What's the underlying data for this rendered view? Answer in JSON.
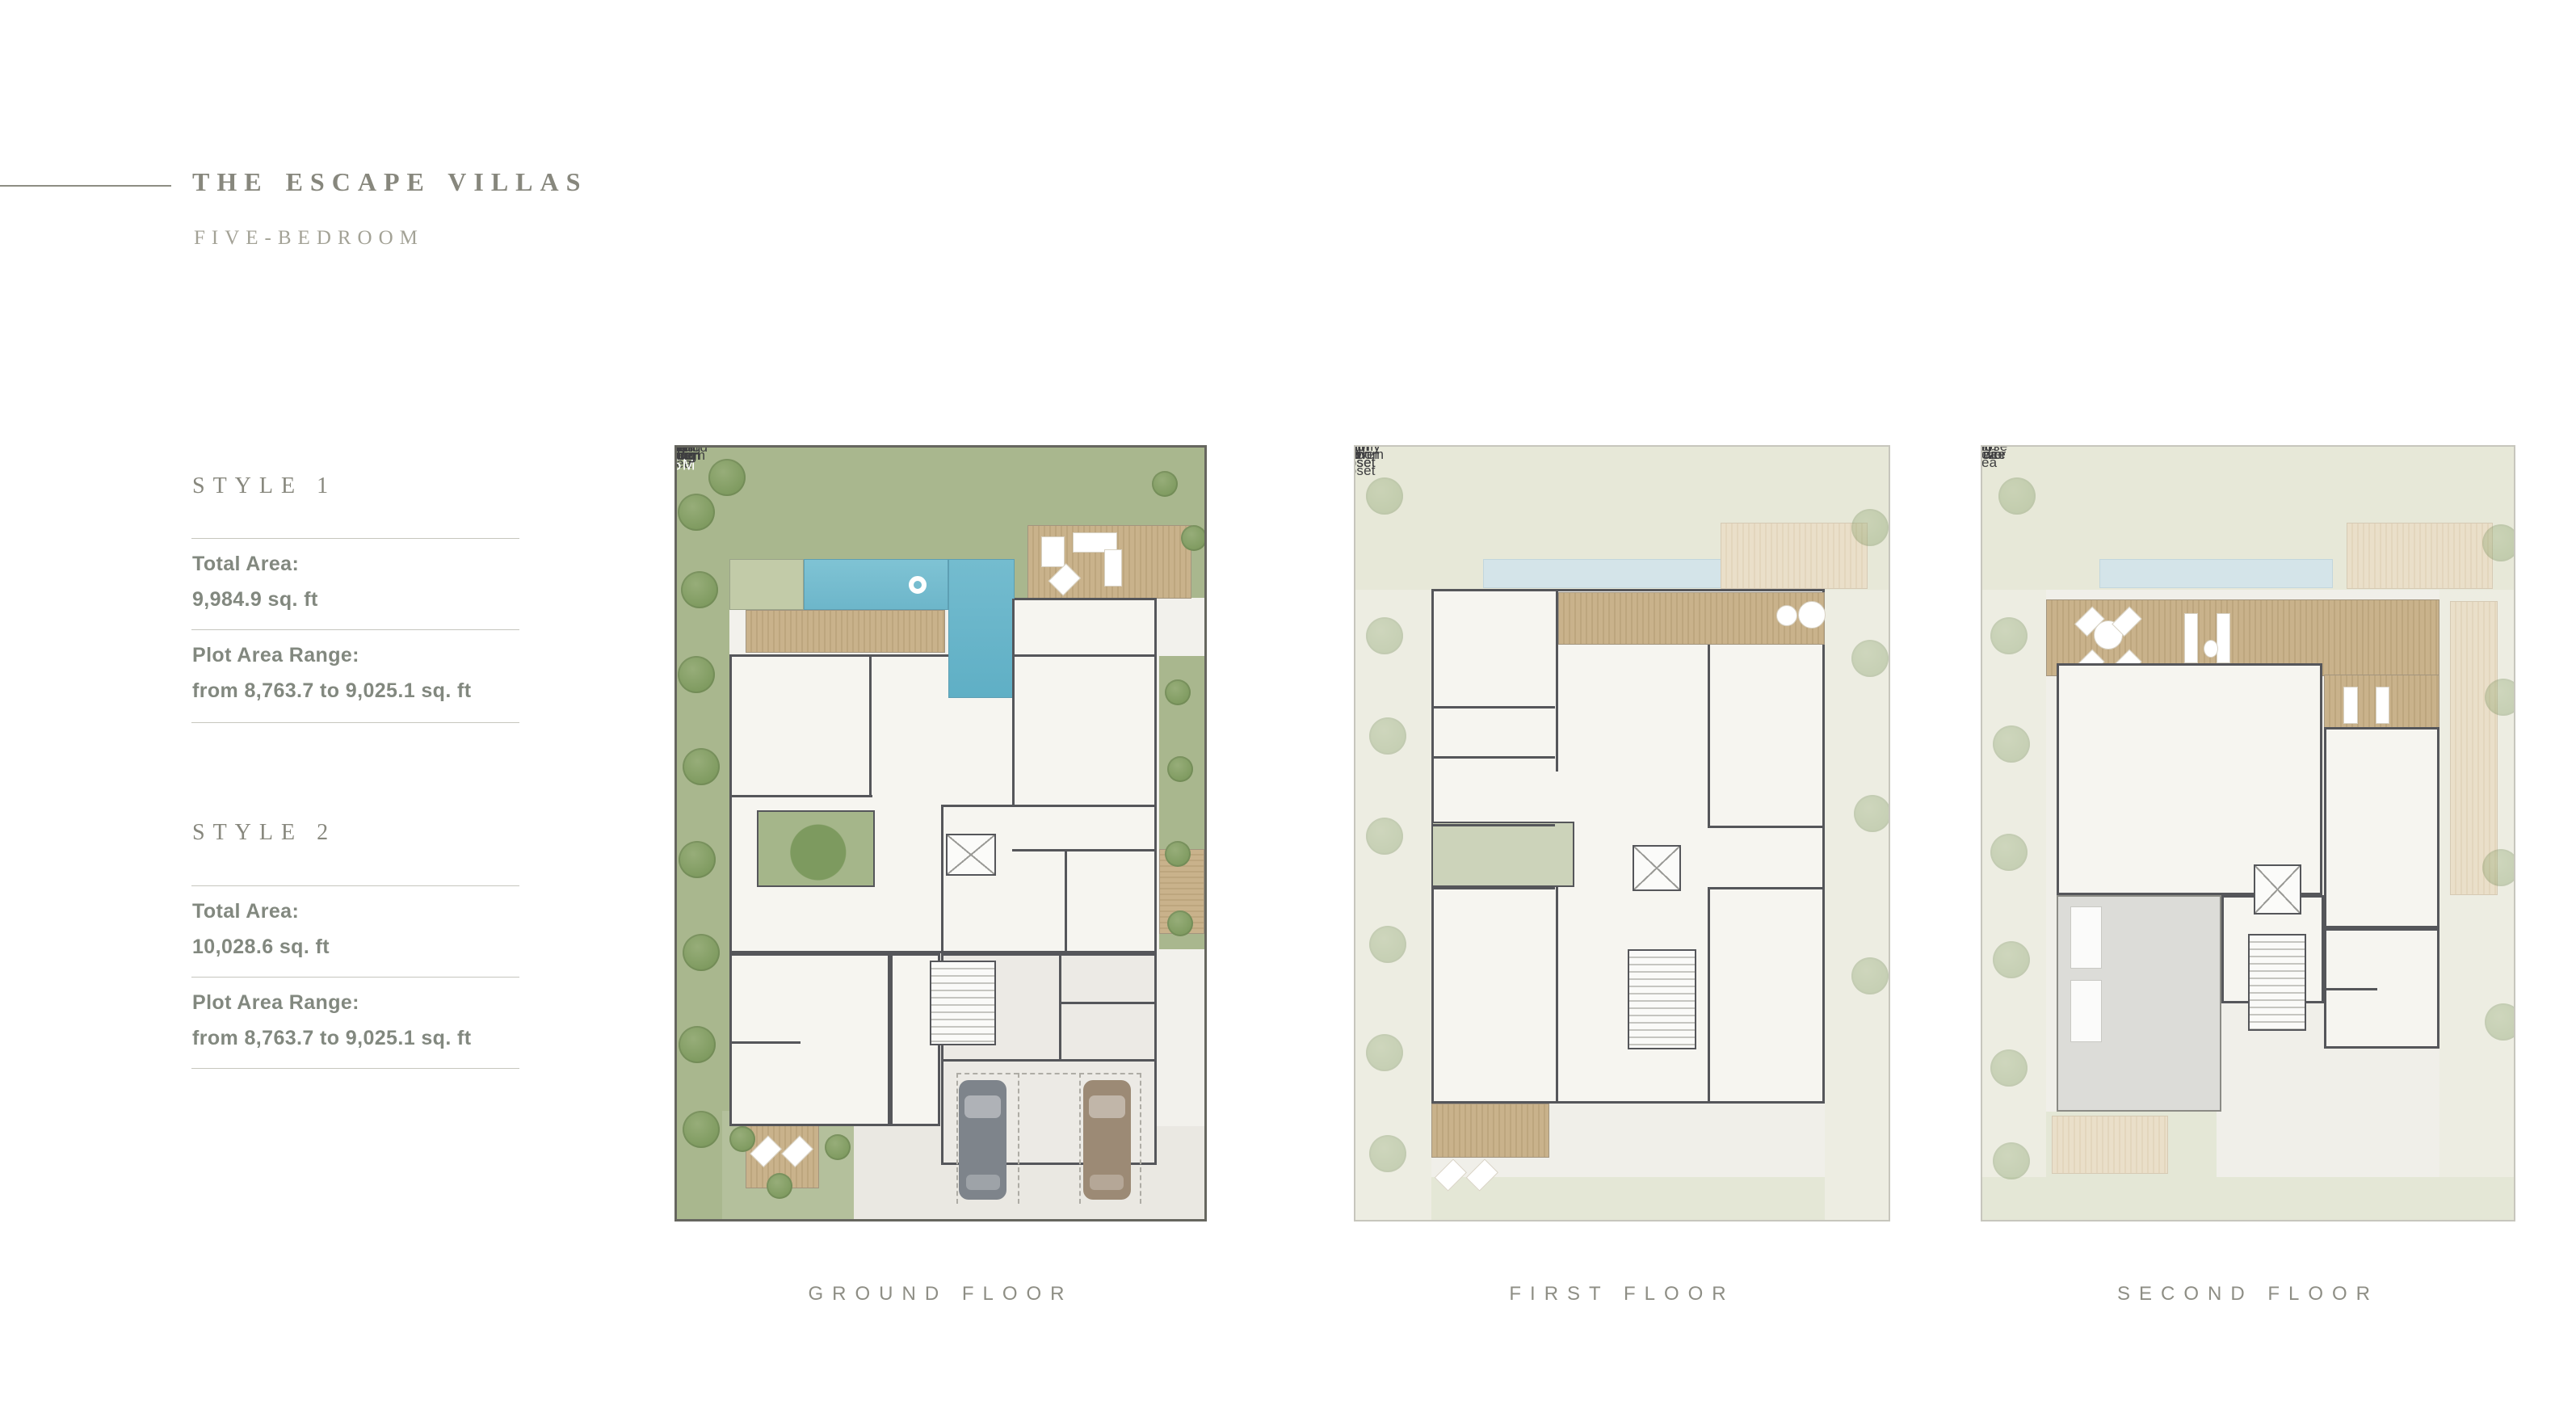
{
  "header": {
    "title": "THE ESCAPE VILLAS",
    "subtitle": "FIVE-BEDROOM"
  },
  "styles": [
    {
      "name": "STYLE 1",
      "total_label": "Total Area:",
      "total_value": "9,984.9 sq. ft",
      "plot_label": "Plot Area Range:",
      "plot_value": "from 8,763.7 to 9,025.1 sq. ft"
    },
    {
      "name": "STYLE 2",
      "total_label": "Total Area:",
      "total_value": "10,028.6 sq. ft",
      "plot_label": "Plot Area Range:",
      "plot_value": "from 8,763.7 to 9,025.1 sq. ft"
    }
  ],
  "floors": [
    {
      "caption": "GROUND FLOOR",
      "labels": [
        {
          "text": "Outdoor\nSeating\nArea",
          "x": 88,
          "y": 14.8
        },
        {
          "text": "9.5 X 2.5M",
          "x": 34.5,
          "y": 17.7,
          "cls": "white"
        },
        {
          "text": "Pool",
          "x": 55.5,
          "y": 20.6
        },
        {
          "text": "Breakfast\nArea",
          "x": 72.5,
          "y": 25.7
        },
        {
          "text": "Family\nLiving",
          "x": 24,
          "y": 35.6
        },
        {
          "text": "Family\nDining",
          "x": 46.5,
          "y": 37
        },
        {
          "text": "DW",
          "x": 56,
          "y": 33.6,
          "cls": "tiny"
        },
        {
          "text": "CM",
          "x": 82.3,
          "y": 31.6,
          "cls": "tiny"
        },
        {
          "text": "Show\nKitchen",
          "x": 74.5,
          "y": 42.9
        },
        {
          "text": "FR",
          "x": 82.9,
          "y": 43.8,
          "cls": "tiny"
        },
        {
          "text": "Courtyard",
          "x": 25,
          "y": 51.8
        },
        {
          "text": "Prep\nKitchen",
          "x": 74,
          "y": 52
        },
        {
          "text": "Lift",
          "x": 55.5,
          "y": 54.3
        },
        {
          "text": "Powder\nRoom",
          "x": 23,
          "y": 62
        },
        {
          "text": "Laundry\nRoom",
          "x": 65.5,
          "y": 63
        },
        {
          "text": "Bath",
          "x": 25,
          "y": 69
        },
        {
          "text": "Foyer",
          "x": 43.5,
          "y": 70.3
        },
        {
          "text": "Maids\nRoom",
          "x": 77.5,
          "y": 68
        },
        {
          "text": "Drivers\nRoom",
          "x": 77.5,
          "y": 74.9
        },
        {
          "text": "Guest\nBedroom",
          "x": 26,
          "y": 82
        },
        {
          "text": "Parking",
          "x": 70,
          "y": 90
        },
        {
          "text": "Entrance\nGarden",
          "x": 25.5,
          "y": 94.5
        }
      ]
    },
    {
      "caption": "FIRST FLOOR",
      "labels": [
        {
          "text": "Balcony",
          "x": 62,
          "y": 22.5
        },
        {
          "text": "Bedroom 1",
          "x": 26.5,
          "y": 26.5
        },
        {
          "text": "Steam\nShower",
          "x": 83.5,
          "y": 29
        },
        {
          "text": "Master\nBath",
          "x": 74,
          "y": 34.8
        },
        {
          "text": "Walk-in\nCloset",
          "x": 25.5,
          "y": 37.6
        },
        {
          "text": "Master\nBedroom",
          "x": 52.5,
          "y": 38.2
        },
        {
          "text": "Bath",
          "x": 23,
          "y": 41.5
        },
        {
          "text": "Master Walk-in\nCloset",
          "x": 75,
          "y": 45.1
        },
        {
          "text": "Lift",
          "x": 56,
          "y": 54.6
        },
        {
          "text": "Bath",
          "x": 25,
          "y": 61.2
        },
        {
          "text": "Bath",
          "x": 80,
          "y": 61.7
        },
        {
          "text": "Walk-in\nCloset",
          "x": 26,
          "y": 66.5
        },
        {
          "text": "Walk-in\nCloset",
          "x": 79.5,
          "y": 66.6
        },
        {
          "text": "Bedroom 3",
          "x": 27,
          "y": 77.4
        },
        {
          "text": "Bedroom 2",
          "x": 78,
          "y": 77.4
        },
        {
          "text": "Balcony",
          "x": 26.5,
          "y": 87.6
        }
      ]
    },
    {
      "caption": "SECOND FLOOR",
      "labels": [
        {
          "text": "Roof\nTerrace",
          "x": 65.5,
          "y": 25.7
        },
        {
          "text": "Lounge\nArea",
          "x": 26.5,
          "y": 38.5
        },
        {
          "text": "Multi-purpose\nArea",
          "x": 52.5,
          "y": 42.9
        },
        {
          "text": "Fitness\nStudio",
          "x": 74.5,
          "y": 48.1
        },
        {
          "text": "Lift",
          "x": 55,
          "y": 55.6
        },
        {
          "text": "Bath",
          "x": 71,
          "y": 72
        },
        {
          "text": "Steam\nShower",
          "x": 81.5,
          "y": 74.9
        }
      ]
    }
  ],
  "colors": {
    "lawn": "#a9b78e",
    "pool": "#74bccf",
    "deck": "#c9b28b",
    "wall": "#55565a",
    "heading_text": "#87877d",
    "body_text": "#82887f",
    "caption_text": "#8e8e85"
  }
}
